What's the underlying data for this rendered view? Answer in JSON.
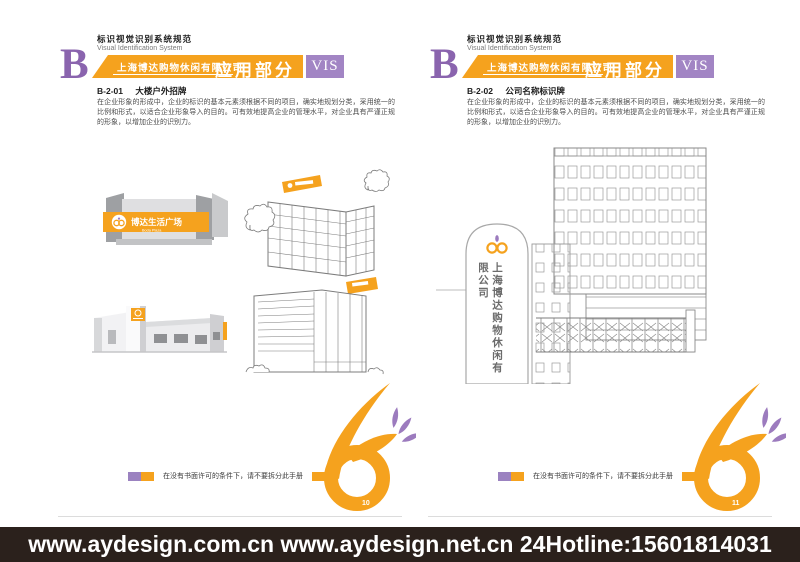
{
  "colors": {
    "orange": "#F5A21E",
    "purple_badge": "#A285C4",
    "purple_letter": "#8A64AE",
    "purple_petal": "#9C7BBE",
    "bottom_bar": "#2B211C"
  },
  "pages": [
    {
      "header": {
        "title_cn": "标识视觉识别系统规范",
        "title_en": "Visual Identification System",
        "letter": "B",
        "company": "上海博达购物休闲有限公司",
        "section": "应用部分",
        "vis": "VIS"
      },
      "section": {
        "code": "B-2-01",
        "title": "大楼户外招牌"
      },
      "body": "在企业形象的形成中，企业的标识的基本元素须根据不同的项目，确实地规划分类，采用统一的比例和形式，以适合企业形象导入的目的。可有效地提高企业的管理水平，对企业具有严谨正规的形象，以增加企业的识别力。",
      "footer_note": "在没有书面许可的条件下，请不要拆分此手册",
      "page_number": "10",
      "illustration": {
        "plaza_sign": "博达生活广场",
        "plaza_sign_en": "Boda Plaza"
      }
    },
    {
      "header": {
        "title_cn": "标识视觉识别系统规范",
        "title_en": "Visual Identification System",
        "letter": "B",
        "company": "上海博达购物休闲有限公司",
        "section": "应用部分",
        "vis": "VIS"
      },
      "section": {
        "code": "B-2-02",
        "title": "公司名称标识牌"
      },
      "body": "在企业形象的形成中，企业的标识的基本元素须根据不同的项目，确实地规划分类，采用统一的比例和形式，以适合企业形象导入的目的。可有效地提高企业的管理水平，对企业具有严谨正规的形象，以增加企业的识别力。",
      "footer_note": "在没有书面许可的条件下，请不要拆分此手册",
      "page_number": "11",
      "illustration": {
        "pylon_text": "上海博达购物休闲有限公司"
      }
    }
  ],
  "bottom_bar": {
    "text": "www.aydesign.com.cn www.aydesign.net.cn 24Hotline:15601814031"
  }
}
